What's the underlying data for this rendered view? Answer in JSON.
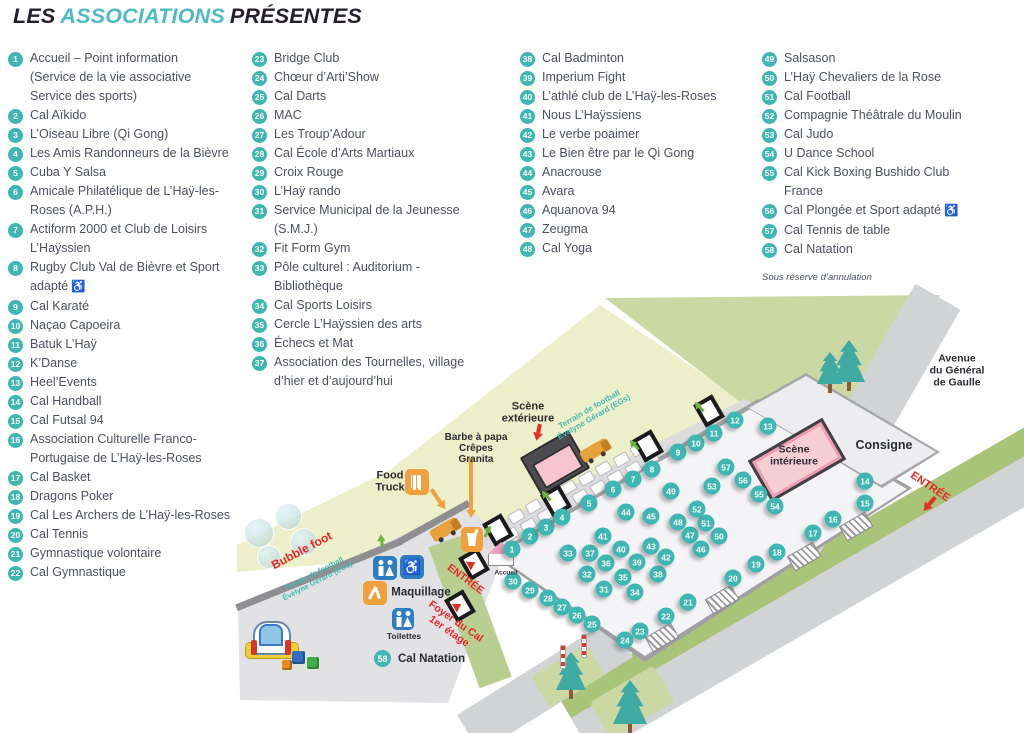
{
  "title": {
    "part1": "LES",
    "part2": "ASSOCIATIONS",
    "part3": "PRÉSENTES"
  },
  "colors": {
    "teal": "#3eb6b2",
    "title_teal": "#4cbcbe",
    "text": "#4f4f5f",
    "dark": "#2b2b33",
    "red": "#e32726",
    "pink_wheelchair": "#e5007d",
    "field": "#ecefc9",
    "green": "#cbd8a3",
    "road": "#d2d3d5",
    "hall": "#f4f4f6",
    "stage_pink": "#f6c3cf",
    "icon_blue": "#2d7dc1",
    "icon_orange": "#f0a13e"
  },
  "footnote": "Sous réserve d’annulation",
  "columns": [
    {
      "items": [
        {
          "n": 1,
          "lines": [
            "Accueil – Point information",
            "(Service de la vie associative",
            "Service des sports)"
          ]
        },
        {
          "n": 2,
          "lines": [
            "Cal Aïkido"
          ]
        },
        {
          "n": 3,
          "lines": [
            "L’Oiseau Libre (Qi Gong)"
          ]
        },
        {
          "n": 4,
          "lines": [
            "Les Amis Randonneurs de la Bièvre"
          ]
        },
        {
          "n": 5,
          "lines": [
            "Cuba Y Salsa"
          ]
        },
        {
          "n": 6,
          "lines": [
            "Amicale Philatélique de L’Haÿ-les-",
            "Roses (A.P.H.)"
          ]
        },
        {
          "n": 7,
          "lines": [
            "Actiform 2000 et Club de Loisirs",
            "L’Haÿssien"
          ]
        },
        {
          "n": 8,
          "lines": [
            "Rugby Club Val de Bièvre et Sport",
            "adapté"
          ],
          "wheelchair": true
        },
        {
          "n": 9,
          "lines": [
            "Cal Karaté"
          ]
        },
        {
          "n": 10,
          "lines": [
            "Naçao Capoeira"
          ]
        },
        {
          "n": 11,
          "lines": [
            "Batuk L’Haÿ"
          ]
        },
        {
          "n": 12,
          "lines": [
            "K’Danse"
          ]
        },
        {
          "n": 13,
          "lines": [
            "Heel’Events"
          ]
        },
        {
          "n": 14,
          "lines": [
            "Cal Handball"
          ]
        },
        {
          "n": 15,
          "lines": [
            "Cal Futsal 94"
          ]
        },
        {
          "n": 16,
          "lines": [
            "Association Culturelle Franco-",
            "Portugaise de L’Haÿ-les-Roses"
          ]
        },
        {
          "n": 17,
          "lines": [
            "Cal Basket"
          ]
        },
        {
          "n": 18,
          "lines": [
            "Dragons Poker"
          ]
        },
        {
          "n": 19,
          "lines": [
            "Cal Les Archers de L’Haÿ-les-Roses"
          ]
        },
        {
          "n": 20,
          "lines": [
            "Cal Tennis"
          ]
        },
        {
          "n": 21,
          "lines": [
            "Gymnastique volontaire"
          ]
        },
        {
          "n": 22,
          "lines": [
            "Cal Gymnastique"
          ]
        }
      ]
    },
    {
      "items": [
        {
          "n": 23,
          "lines": [
            "Bridge Club"
          ]
        },
        {
          "n": 24,
          "lines": [
            "Chœur d’Arti’Show"
          ]
        },
        {
          "n": 25,
          "lines": [
            "Cal Darts"
          ]
        },
        {
          "n": 26,
          "lines": [
            "MAC"
          ]
        },
        {
          "n": 27,
          "lines": [
            "Les Troup’Adour"
          ]
        },
        {
          "n": 28,
          "lines": [
            "Cal École d’Arts Martiaux"
          ]
        },
        {
          "n": 29,
          "lines": [
            "Croix Rouge"
          ]
        },
        {
          "n": 30,
          "lines": [
            "L’Haÿ rando"
          ]
        },
        {
          "n": 31,
          "lines": [
            "Service Municipal de la Jeunesse",
            "(S.M.J.)"
          ]
        },
        {
          "n": 32,
          "lines": [
            "Fit Form Gym"
          ]
        },
        {
          "n": 33,
          "lines": [
            "Pôle culturel : Auditorium -",
            "Bibliothèque"
          ]
        },
        {
          "n": 34,
          "lines": [
            "Cal Sports Loisirs"
          ]
        },
        {
          "n": 35,
          "lines": [
            "Cercle L’Haÿssien des arts"
          ]
        },
        {
          "n": 36,
          "lines": [
            "Échecs et Mat"
          ]
        },
        {
          "n": 37,
          "lines": [
            "Association des Tournelles, village",
            "d’hier et d’aujourd’hui"
          ]
        }
      ]
    },
    {
      "items": [
        {
          "n": 38,
          "lines": [
            "Cal Badminton"
          ]
        },
        {
          "n": 39,
          "lines": [
            "Imperium Fight"
          ]
        },
        {
          "n": 40,
          "lines": [
            "L’athlé club de L’Haÿ-les-Roses"
          ]
        },
        {
          "n": 41,
          "lines": [
            "Nous L’Haÿssiens"
          ]
        },
        {
          "n": 42,
          "lines": [
            "Le verbe poaimer"
          ]
        },
        {
          "n": 43,
          "lines": [
            "Le Bien être par le Qi Gong"
          ]
        },
        {
          "n": 44,
          "lines": [
            "Anacrouse"
          ]
        },
        {
          "n": 45,
          "lines": [
            "Avara"
          ]
        },
        {
          "n": 46,
          "lines": [
            "Aquanova 94"
          ]
        },
        {
          "n": 47,
          "lines": [
            "Zeugma"
          ]
        },
        {
          "n": 48,
          "lines": [
            "Cal Yoga"
          ]
        }
      ]
    },
    {
      "items": [
        {
          "n": 49,
          "lines": [
            "Salsason"
          ]
        },
        {
          "n": 50,
          "lines": [
            "L’Haÿ Chevaliers de la Rose"
          ]
        },
        {
          "n": 51,
          "lines": [
            "Cal Football"
          ]
        },
        {
          "n": 52,
          "lines": [
            "Compagnie Théâtrale du Moulin"
          ]
        },
        {
          "n": 53,
          "lines": [
            "Cal Judo"
          ]
        },
        {
          "n": 54,
          "lines": [
            "U Dance School"
          ]
        },
        {
          "n": 55,
          "lines": [
            "Cal Kick Boxing Bushido Club",
            "France"
          ]
        },
        {
          "n": 56,
          "lines": [
            "Cal Plongée et Sport adapté"
          ],
          "wheelchair": true
        },
        {
          "n": 57,
          "lines": [
            "Cal Tennis de table"
          ]
        },
        {
          "n": 58,
          "lines": [
            "Cal Natation"
          ]
        }
      ]
    }
  ],
  "map": {
    "legend": {
      "n": "58",
      "label": "Cal Natation"
    },
    "markers": [
      [
        1,
        512,
        549
      ],
      [
        2,
        530,
        536
      ],
      [
        3,
        546,
        527
      ],
      [
        4,
        562,
        517
      ],
      [
        5,
        589,
        503
      ],
      [
        6,
        613,
        489
      ],
      [
        7,
        633,
        479
      ],
      [
        8,
        652,
        469
      ],
      [
        9,
        678,
        452
      ],
      [
        10,
        696,
        443
      ],
      [
        11,
        714,
        433
      ],
      [
        12,
        735,
        420
      ],
      [
        13,
        768,
        426
      ],
      [
        14,
        865,
        481
      ],
      [
        15,
        865,
        503
      ],
      [
        16,
        833,
        519
      ],
      [
        17,
        813,
        533
      ],
      [
        18,
        777,
        552
      ],
      [
        19,
        756,
        564
      ],
      [
        20,
        733,
        578
      ],
      [
        21,
        688,
        602
      ],
      [
        22,
        666,
        616
      ],
      [
        23,
        640,
        631
      ],
      [
        24,
        625,
        640
      ],
      [
        25,
        592,
        624
      ],
      [
        26,
        577,
        615
      ],
      [
        27,
        562,
        607
      ],
      [
        28,
        548,
        598
      ],
      [
        29,
        530,
        590
      ],
      [
        30,
        513,
        581
      ],
      [
        31,
        604,
        589
      ],
      [
        32,
        587,
        574
      ],
      [
        33,
        568,
        553
      ],
      [
        34,
        635,
        592
      ],
      [
        35,
        623,
        577
      ],
      [
        36,
        606,
        563
      ],
      [
        37,
        590,
        553
      ],
      [
        38,
        658,
        574
      ],
      [
        39,
        637,
        562
      ],
      [
        40,
        621,
        549
      ],
      [
        41,
        603,
        536
      ],
      [
        42,
        666,
        557
      ],
      [
        43,
        651,
        546
      ],
      [
        44,
        626,
        512
      ],
      [
        45,
        651,
        516
      ],
      [
        46,
        701,
        549
      ],
      [
        47,
        690,
        535
      ],
      [
        48,
        678,
        522
      ],
      [
        49,
        671,
        491
      ],
      [
        50,
        719,
        536
      ],
      [
        51,
        706,
        523
      ],
      [
        52,
        697,
        509
      ],
      [
        53,
        712,
        486
      ],
      [
        54,
        775,
        506
      ],
      [
        55,
        759,
        494
      ],
      [
        56,
        743,
        480
      ],
      [
        57,
        726,
        467
      ]
    ],
    "labels": [
      {
        "id": "scene-exterieure",
        "lines": [
          "Scène",
          "extérieure"
        ],
        "x": 528,
        "y": 413,
        "rot": 0,
        "size": 11,
        "color": "#2b2b33",
        "weight": "bold"
      },
      {
        "id": "barbe-a-papa",
        "lines": [
          "Barbe à papa",
          "Crêpes",
          "Granita"
        ],
        "x": 476,
        "y": 449,
        "rot": 0,
        "size": 10,
        "color": "#2b2b33",
        "weight": "bold"
      },
      {
        "id": "food-truck",
        "lines": [
          "Food",
          "Truck"
        ],
        "x": 390,
        "y": 482,
        "rot": 0,
        "size": 11,
        "color": "#2b2b33",
        "weight": "bold"
      },
      {
        "id": "maquillage",
        "lines": [
          "Maquillage"
        ],
        "x": 421,
        "y": 593,
        "rot": 0,
        "size": 11.5,
        "color": "#2b2b33",
        "weight": "bold"
      },
      {
        "id": "toilettes",
        "lines": [
          "Toilettes"
        ],
        "x": 404,
        "y": 637,
        "rot": 0,
        "size": 8.5,
        "color": "#2b2b33",
        "weight": "bold"
      },
      {
        "id": "accueil",
        "lines": [
          "Accueil"
        ],
        "x": 506,
        "y": 573,
        "rot": 0,
        "size": 6.5,
        "color": "#2b2b33",
        "weight": "bold"
      },
      {
        "id": "consigne",
        "lines": [
          "Consigne"
        ],
        "x": 884,
        "y": 445,
        "rot": 0,
        "size": 12.5,
        "color": "#2b2b33",
        "weight": "bold"
      },
      {
        "id": "avenue",
        "lines": [
          "Avenue",
          "du Général",
          "de Gaulle"
        ],
        "x": 957,
        "y": 371,
        "rot": 0,
        "size": 10.5,
        "color": "#2b2b33",
        "weight": "bold"
      },
      {
        "id": "entree-avenue",
        "lines": [
          "ENTRÉE"
        ],
        "x": 930,
        "y": 487,
        "rot": 34,
        "size": 11,
        "color": "#e32726",
        "weight": "bold"
      },
      {
        "id": "entree-esplanade",
        "lines": [
          "ENTRÉE"
        ],
        "x": 465,
        "y": 580,
        "rot": 37,
        "size": 10.5,
        "color": "#e32726",
        "weight": "bold"
      },
      {
        "id": "foyer-du-cal",
        "lines": [
          "Foyer du Cal",
          "1er étage"
        ],
        "x": 452,
        "y": 627,
        "rot": 35,
        "size": 10.5,
        "color": "#e32726",
        "weight": "bold"
      },
      {
        "id": "bubble-foot",
        "lines": [
          "Bubble foot"
        ],
        "x": 302,
        "y": 551,
        "rot": -28,
        "size": 12,
        "color": "#e32726",
        "weight": "bold"
      },
      {
        "id": "terrain-strip",
        "lines": [
          "Terrain de football",
          "Évelyne  Gérard (EGs)"
        ],
        "x": 316,
        "y": 578,
        "rot": -27,
        "size": 7.5,
        "color": "#45b8b5",
        "weight": "bold"
      },
      {
        "id": "terrain-top",
        "lines": [
          "Terrain de football",
          "Évelyne  Gérard (EGs)"
        ],
        "x": 592,
        "y": 414,
        "rot": -30,
        "size": 8,
        "color": "#45b8b5",
        "weight": "bold"
      },
      {
        "id": "scene-interieure",
        "lines": [
          "Scène",
          "intérieure"
        ],
        "x": 794,
        "y": 456,
        "rot": 0,
        "size": 10.5,
        "color": "#2b2b33",
        "weight": "bold"
      }
    ]
  }
}
